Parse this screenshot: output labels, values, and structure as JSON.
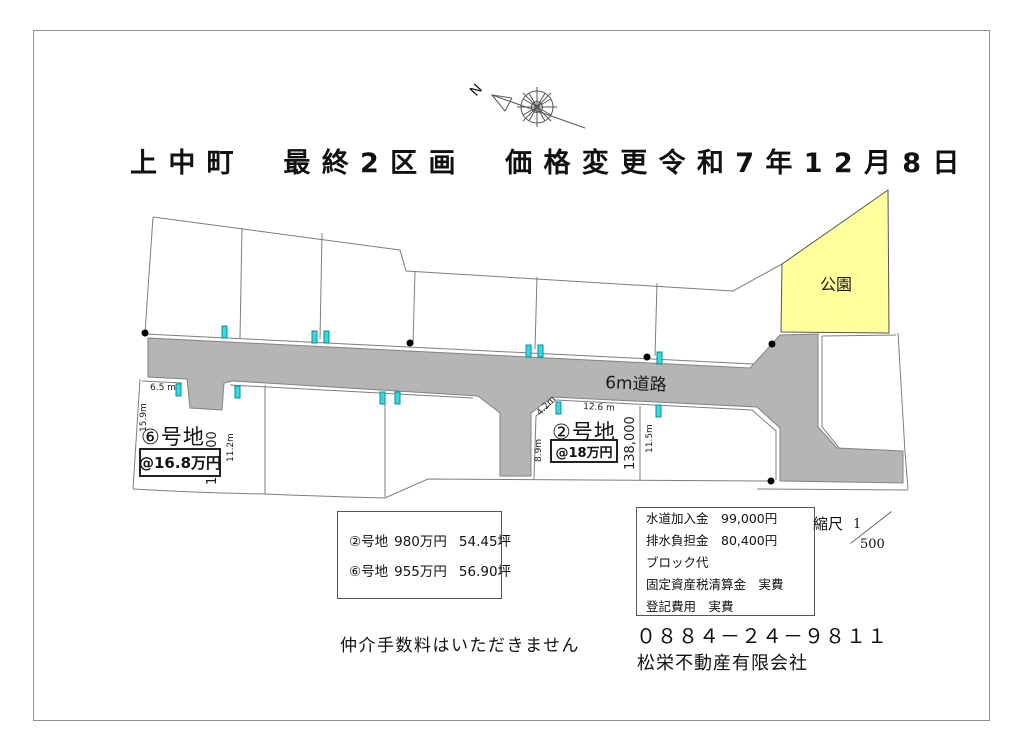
{
  "title": "上中町　最終2区画　価格変更令和7年12月8日",
  "compass": {
    "north_label": "N"
  },
  "map": {
    "road_label": "6m道路",
    "park_label": "公園",
    "plots": {
      "plot6": {
        "name": "⑥号地",
        "unit_price": "@16.8万円",
        "tsubo_price": "160,000",
        "dim_top": "6.5 m",
        "dim_left": "15.9m",
        "dim_right": "11.2m"
      },
      "plot2": {
        "name": "②号地",
        "unit_price": "@18万円",
        "tsubo_price": "138,000",
        "dim_top": "12.6 m",
        "dim_diagonal": "4.2m",
        "dim_left": "8.9m",
        "dim_right": "11.5m"
      }
    }
  },
  "price_table": {
    "rows": [
      {
        "plot": "②号地",
        "price": "980万円",
        "area": "54.45坪"
      },
      {
        "plot": "⑥号地",
        "price": "955万円",
        "area": "56.90坪"
      }
    ]
  },
  "fees": {
    "lines": [
      "水道加入金　99,000円",
      "排水負担金　80,400円",
      "ブロック代",
      "固定資産税清算金　実費",
      "登記費用　実費"
    ]
  },
  "scale": {
    "label": "縮尺",
    "numerator": "1",
    "denominator": "500"
  },
  "notice": "仲介手数料はいただきません",
  "contact": {
    "phone": "０８８４－２４－９８１１",
    "company": "松栄不動産有限会社"
  },
  "colors": {
    "road": "#b5b5b5",
    "park": "#ffff9e",
    "marker": "#35dbe3"
  }
}
